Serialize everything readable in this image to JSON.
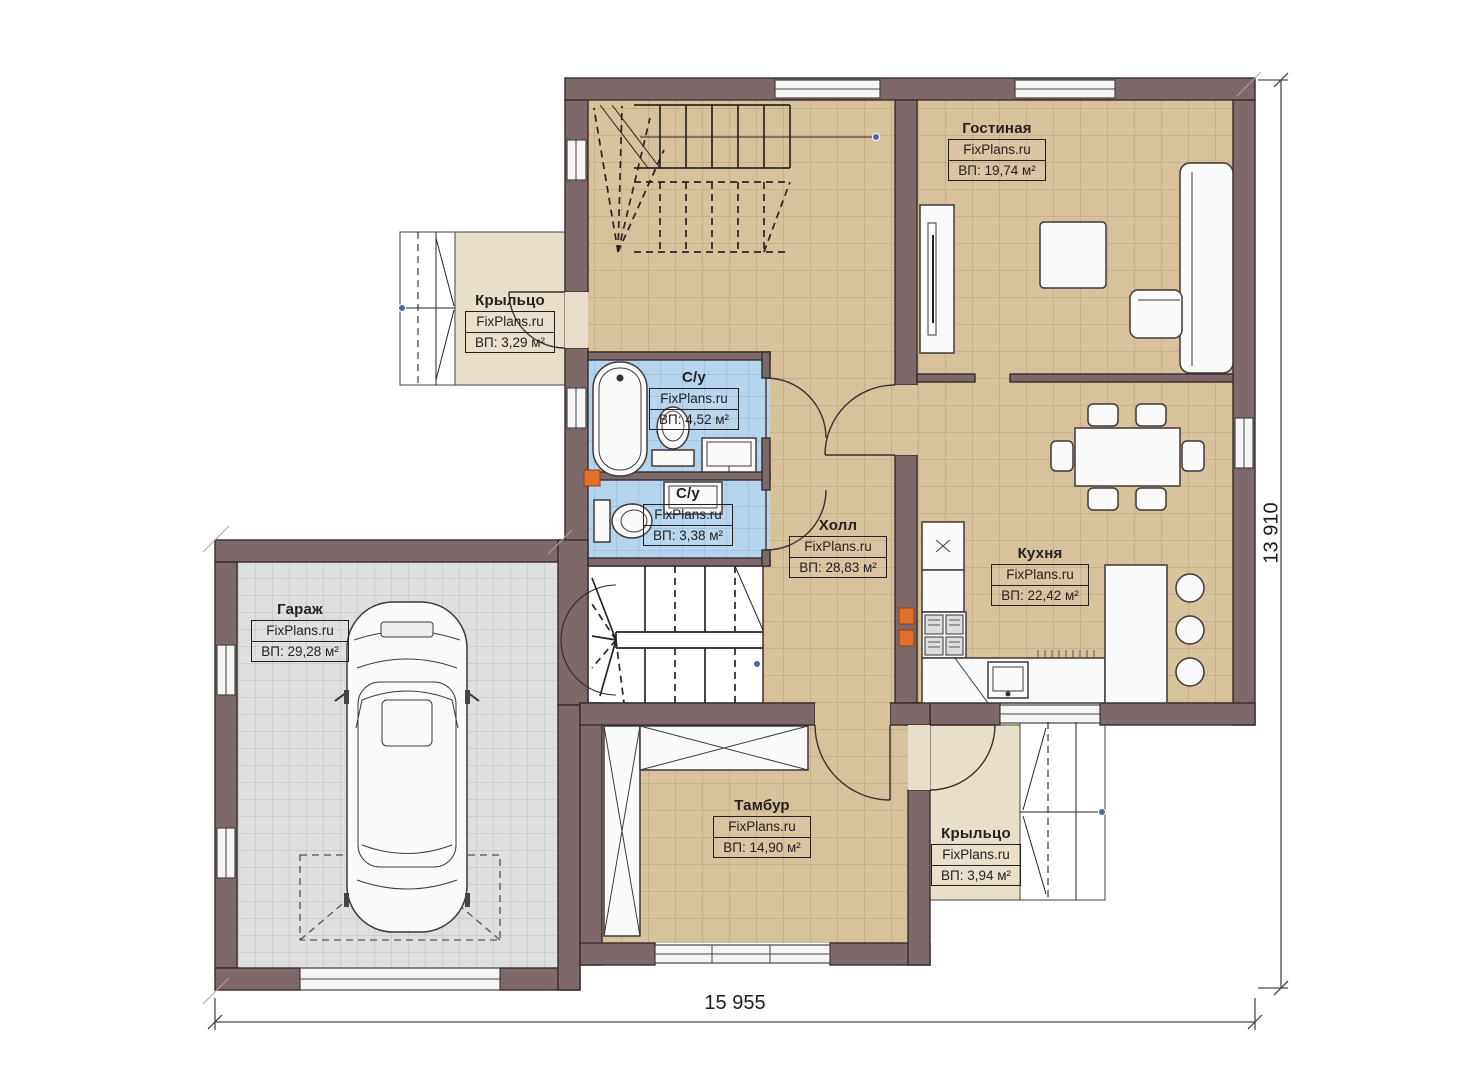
{
  "plan": {
    "watermark": "FixPlans.ru",
    "rooms": [
      {
        "name": "Гостиная",
        "area": "ВП: 19,74 м²"
      },
      {
        "name": "Крыльцо",
        "area": "ВП: 3,29 м²"
      },
      {
        "name": "С/у",
        "area": "ВП: 4,52 м²"
      },
      {
        "name": "С/у",
        "area": "ВП: 3,38 м²"
      },
      {
        "name": "Холл",
        "area": "ВП: 28,83 м²"
      },
      {
        "name": "Кухня",
        "area": "ВП: 22,42 м²"
      },
      {
        "name": "Гараж",
        "area": "ВП: 29,28 м²"
      },
      {
        "name": "Тамбур",
        "area": "ВП: 14,90 м²"
      },
      {
        "name": "Крыльцо",
        "area": "ВП: 3,94 м²"
      }
    ],
    "dimensions": {
      "bottom": "15 955",
      "right": "13 910"
    },
    "colors": {
      "wall": "#7d696a",
      "floor_main": "#d7c29c",
      "floor_bath": "#b5d4ee",
      "floor_garage": "#dfdfdf",
      "floor_porch": "#e8dfca",
      "marker_orange": "#e2702d",
      "node_blue": "#4a67a8"
    }
  }
}
